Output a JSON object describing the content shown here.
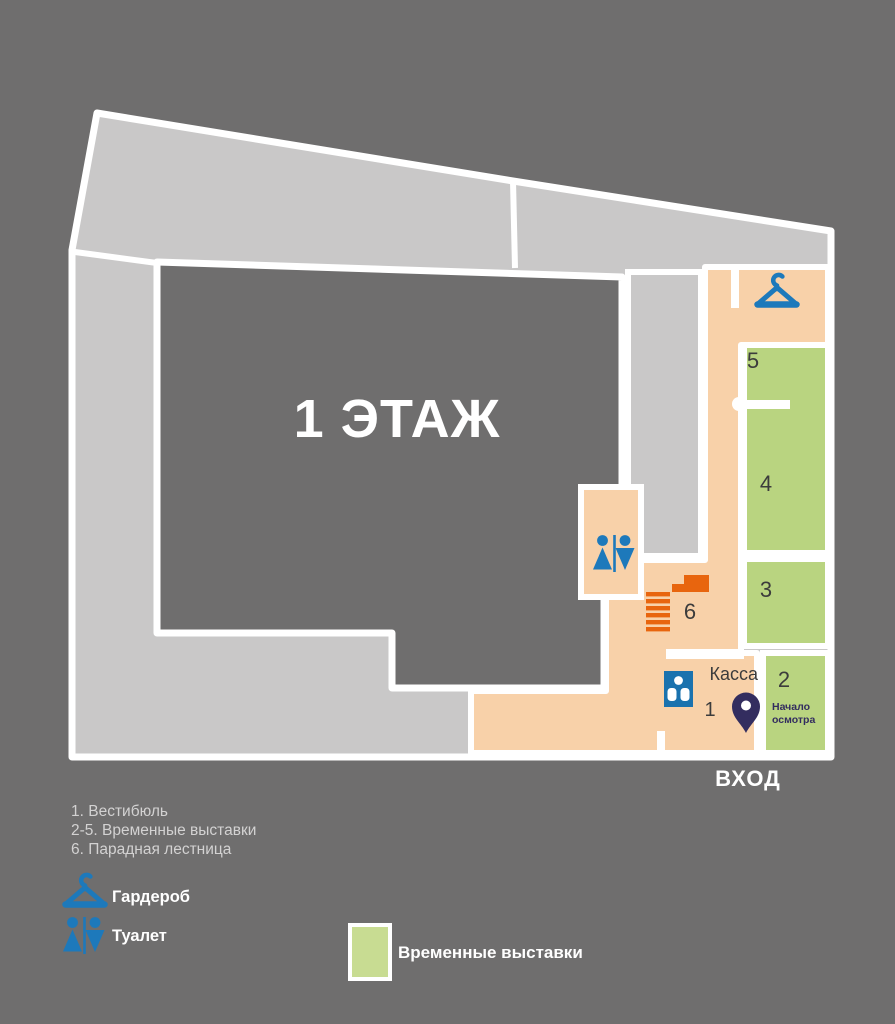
{
  "plan": {
    "floor_title": "1 ЭТАЖ",
    "entrance_label": "ВХОД",
    "ticket_office_label": "Касса",
    "tour_start_label": "Начало осмотра",
    "room_numbers": {
      "r1": "1",
      "r2": "2",
      "r3": "3",
      "r4": "4",
      "r5": "5",
      "r6": "6"
    }
  },
  "legend": {
    "items": [
      {
        "label": "1. Вестибюль"
      },
      {
        "label": "2-5. Временные выставки"
      },
      {
        "label": "6. Парадная лестница"
      }
    ],
    "cloakroom_label": "Гардероб",
    "toilet_label": "Туалет",
    "temporary_exhibitions_label": "Временные выставки"
  },
  "icons": {
    "cloakroom": "hanger-icon",
    "toilet": "wc-figures-icon",
    "elevator": "elevator-icon",
    "stairs": "stairs-icon",
    "tour_start": "map-pin-icon"
  },
  "colors": {
    "background": "#6f6e6e",
    "walls": "#ffffff",
    "band_gray": "#c9c8c8",
    "circulation_peach": "#f8d1a9",
    "exhibition_green": "#b9d480",
    "legend_green": "#c8dc92",
    "icon_blue": "#1d79bb",
    "elevator_blue": "#1a72ae",
    "stairs_orange": "#e8650e",
    "pin_navy": "#332d5f",
    "label_dark": "#3c3c3c",
    "legend_text": "#d3d2d2"
  }
}
